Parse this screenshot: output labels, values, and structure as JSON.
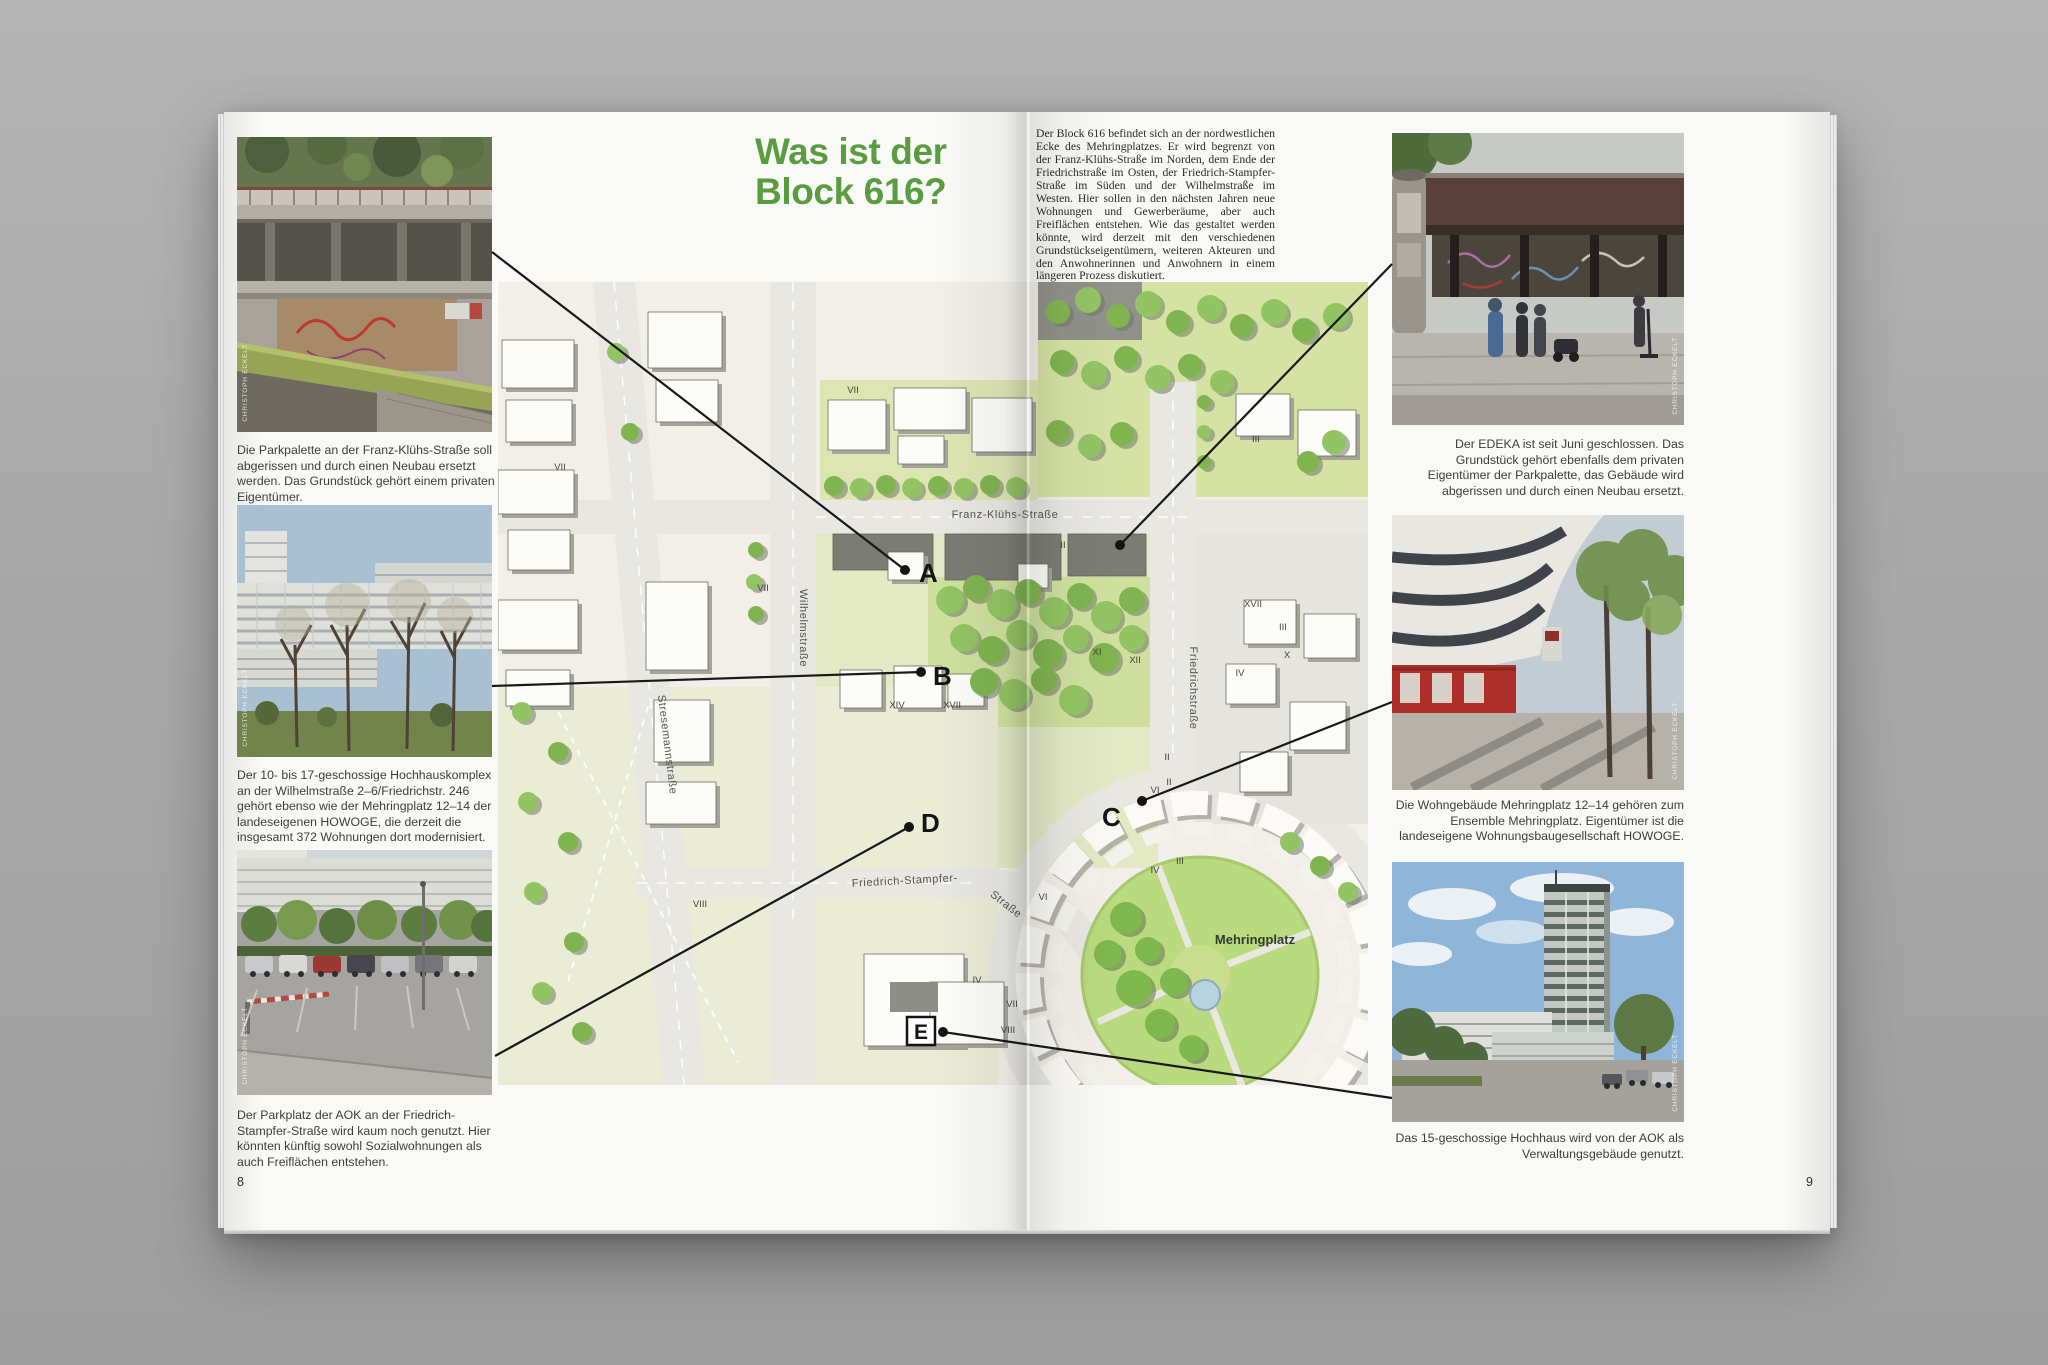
{
  "document": {
    "title_line1": "Was ist der",
    "title_line2": "Block 616?",
    "accent_green": "#5a9c40",
    "page_number_left": "8",
    "page_number_right": "9",
    "photo_credit": "CHRISTOPH ECKELT",
    "intro": "Der Block 616 befindet sich an der nordwestlichen Ecke des Mehringplatzes. Er wird begrenzt von der Franz-Klühs-Straße im Norden, dem Ende der Friedrichstraße im Osten, der Friedrich-Stampfer-Straße im Süden und der Wilhelmstraße im Westen. Hier sollen in den nächsten Jahren neue Wohnungen und Gewerberäume, aber auch Freiflächen entstehen. Wie das gestaltet werden könnte, wird derzeit mit den verschiedenen Grundstückseigentümern, weiteren Akteuren und den Anwohnerinnen und Anwohnern in einem längeren Prozess diskutiert."
  },
  "captions": {
    "parkpalette": "Die Parkpalette an der Franz-Klühs-Straße soll abgerissen und durch einen Neubau ersetzt werden. Das Grundstück gehört einem privaten Eigentümer.",
    "hochhauskomplex": "Der 10- bis 17-geschossige Hochhauskomplex an der Wilhelmstraße 2–6/Friedrichstr. 246 gehört ebenso wie der Mehringplatz 12–14 der landeseigenen HOWOGE, die derzeit die insgesamt 372 Wohnungen dort modernisiert.",
    "aok_parkplatz": "Der Parkplatz der AOK an der Friedrich-Stampfer-Straße wird kaum noch genutzt. Hier könnten künftig sowohl Sozialwohnungen als auch Freiflächen entstehen.",
    "edeka": "Der EDEKA ist seit Juni geschlossen. Das Grundstück gehört ebenfalls dem privaten Eigentümer der Parkpalette, das Gebäude wird abgerissen und durch einen Neubau ersetzt.",
    "mehringplatz_wohngebaeude": "Die Wohngebäude Mehringplatz 12–14 gehören zum Ensemble Mehringplatz. Eigentümer ist die landeseigene Wohnungsbaugesellschaft HOWOGE.",
    "aok_hochhaus": "Das 15-geschossige Hochhaus wird von der AOK als Verwaltungsgebäude genutzt."
  },
  "map": {
    "street_labels": [
      {
        "text": "Franz-Klühs-Straße",
        "x": 507,
        "y": 236,
        "rot": 0
      },
      {
        "text": "Wilhelmstraße",
        "x": 302,
        "y": 346,
        "rot": 90
      },
      {
        "text": "Friedrichstraße",
        "x": 692,
        "y": 406,
        "rot": 90
      },
      {
        "text": "Stresemannstraße",
        "x": 166,
        "y": 463,
        "rot": 83
      },
      {
        "text": "Friedrich-Stampfer-",
        "x": 407,
        "y": 602,
        "rot": -3
      },
      {
        "text": "Straße",
        "x": 506,
        "y": 625,
        "rot": 38
      }
    ],
    "place_labels": [
      {
        "text": "Mehringplatz",
        "x": 757,
        "y": 662
      }
    ],
    "numerals": [
      {
        "t": "VII",
        "x": 355,
        "y": 111
      },
      {
        "t": "VII",
        "x": 62,
        "y": 188
      },
      {
        "t": "VII",
        "x": 265,
        "y": 309
      },
      {
        "t": "II",
        "x": 565,
        "y": 266
      },
      {
        "t": "XIV",
        "x": 399,
        "y": 426
      },
      {
        "t": "XVII",
        "x": 454,
        "y": 426
      },
      {
        "t": "XI",
        "x": 599,
        "y": 373
      },
      {
        "t": "XII",
        "x": 637,
        "y": 381
      },
      {
        "t": "XVII",
        "x": 755,
        "y": 325
      },
      {
        "t": "III",
        "x": 785,
        "y": 348
      },
      {
        "t": "X",
        "x": 789,
        "y": 376
      },
      {
        "t": "IV",
        "x": 742,
        "y": 394
      },
      {
        "t": "II",
        "x": 669,
        "y": 478
      },
      {
        "t": "II",
        "x": 671,
        "y": 503
      },
      {
        "t": "VI",
        "x": 657,
        "y": 511
      },
      {
        "t": "III",
        "x": 682,
        "y": 582
      },
      {
        "t": "IV",
        "x": 657,
        "y": 591
      },
      {
        "t": "VI",
        "x": 545,
        "y": 618
      },
      {
        "t": "IV",
        "x": 479,
        "y": 701
      },
      {
        "t": "VII",
        "x": 514,
        "y": 725
      },
      {
        "t": "VIII",
        "x": 510,
        "y": 751
      },
      {
        "t": "VIII",
        "x": 202,
        "y": 625
      },
      {
        "t": "III",
        "x": 758,
        "y": 160
      }
    ],
    "markers": [
      {
        "letter": "A",
        "lx": 695,
        "ly": 470,
        "dx": 681,
        "dy": 458,
        "boxed": false
      },
      {
        "letter": "B",
        "lx": 709,
        "ly": 573,
        "dx": 697,
        "dy": 560,
        "boxed": false
      },
      {
        "letter": "C",
        "lx": 878,
        "ly": 714,
        "dx": 918,
        "dy": 689,
        "boxed": false
      },
      {
        "letter": "D",
        "lx": 697,
        "ly": 720,
        "dx": 685,
        "dy": 715,
        "boxed": false
      },
      {
        "letter": "E",
        "lx": 697,
        "ly": 927,
        "dx": 719,
        "dy": 920,
        "boxed": true
      },
      {
        "letter": "",
        "lx": 0,
        "ly": 0,
        "dx": 896,
        "dy": 433,
        "boxed": false
      }
    ],
    "connectors": [
      [
        268,
        140,
        681,
        458
      ],
      [
        268,
        574,
        697,
        560
      ],
      [
        685,
        715,
        271,
        944
      ],
      [
        1168,
        152,
        896,
        433
      ],
      [
        918,
        689,
        1168,
        590
      ],
      [
        719,
        920,
        1168,
        986
      ]
    ]
  }
}
